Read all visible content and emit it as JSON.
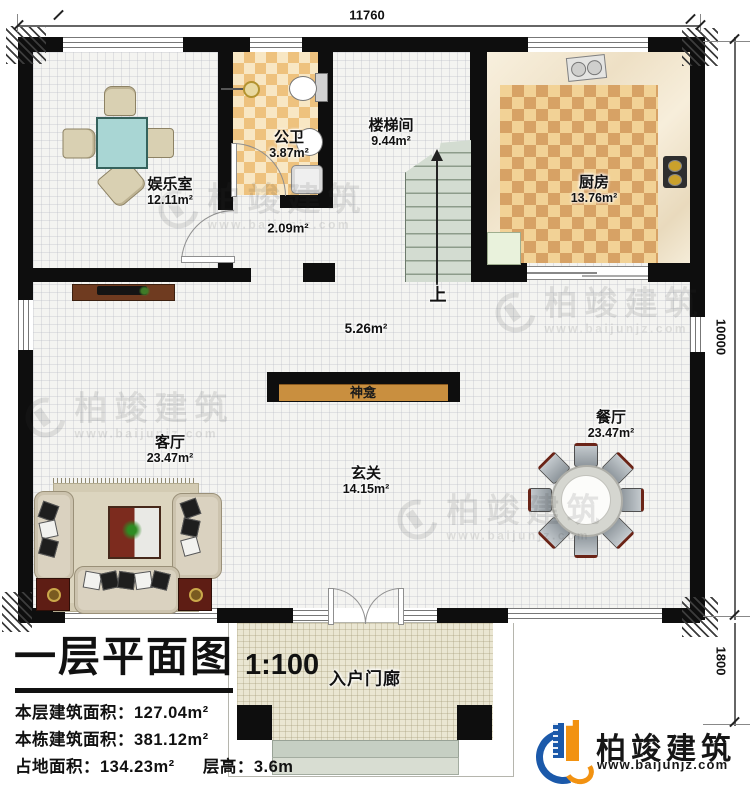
{
  "dimensions": {
    "top": "11760",
    "side": "10000",
    "porch": "1800"
  },
  "rooms": {
    "entertainment": {
      "name": "娱乐室",
      "area": "12.11m²"
    },
    "bathroom": {
      "name": "公卫",
      "area": "3.87m²"
    },
    "hallway": {
      "area": "2.09m²"
    },
    "stairwell": {
      "name": "楼梯间",
      "area": "9.44m²"
    },
    "kitchen": {
      "name": "厨房",
      "area": "13.76m²"
    },
    "living": {
      "name": "客厅",
      "area": "23.47m²"
    },
    "foyer": {
      "name": "玄关",
      "area": "14.15m²"
    },
    "dining": {
      "name": "餐厅",
      "area": "23.47m²"
    },
    "porch": {
      "name": "入户门廊"
    },
    "open_area": {
      "area": "5.26m²"
    }
  },
  "fixtures": {
    "shrine": "神龛",
    "stairs_up": "上"
  },
  "title_block": {
    "title": "一层平面图",
    "scale": "1:100",
    "rows": [
      {
        "label": "本层建筑面积：",
        "value": "127.04m²"
      },
      {
        "label": "本栋建筑面积：",
        "value": "381.12m²"
      },
      {
        "label": "占地面积：",
        "value": "134.23m²",
        "label2": "层高：",
        "value2": "3.6m"
      }
    ]
  },
  "branding": {
    "company": "柏竣建筑",
    "website": "www.baijunjz.com"
  },
  "watermark": {
    "company": "柏竣建筑",
    "website": "www.baijunjz.com"
  },
  "colors": {
    "wall": "#0e0e0e",
    "kitchen_tile": "#d7a265",
    "bath_tile": "#eec27e",
    "brand_blue": "#1b59aa",
    "brand_orange": "#f29211"
  }
}
